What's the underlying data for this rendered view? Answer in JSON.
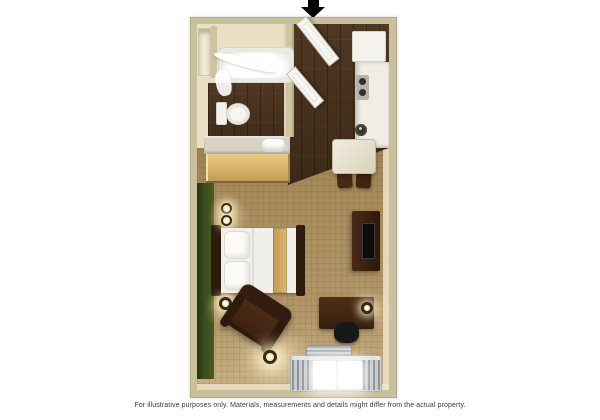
{
  "meta": {
    "kind": "3d-rendered studio suite floor plan",
    "width": 600,
    "height": 420,
    "background": "#ffffff"
  },
  "caption": "For illustrative purposes only.  Materials, measurements and details might differ from the actual property.",
  "entrance": {
    "icon": "down-arrow",
    "color": "#000000"
  },
  "palette": {
    "outer_wall": "#c9c09e",
    "interior_wall": "#e9dfc5",
    "dark_wood_floor": "#44301f",
    "carpet": "#aa8e5f",
    "accent_wall_green": "#3d4d1c",
    "furniture_wood": "#3a2010",
    "bedding_white": "#f1efe9",
    "bed_runner_gold": "#d3ab63",
    "counter_white": "#efede4",
    "vanity_wood": "#d6b267",
    "window_light": "#ffffff"
  },
  "rooms": [
    {
      "name": "bathroom",
      "features": [
        "bathtub",
        "shower-curtain",
        "toilet",
        "closet-nook"
      ]
    },
    {
      "name": "vanity-closet",
      "features": [
        "vanity-counter",
        "towel",
        "vanity-cabinet"
      ]
    },
    {
      "name": "entry-hall",
      "features": [
        "entry-door",
        "bathroom-door",
        "dark-wood-floor"
      ]
    },
    {
      "name": "kitchenette",
      "features": [
        "refrigerator",
        "counter",
        "cooktop",
        "sink"
      ]
    },
    {
      "name": "living-sleeping-area",
      "features": [
        "bed",
        "armchair",
        "desk",
        "tv-dresser",
        "dining-table",
        "window"
      ]
    }
  ],
  "furniture": [
    "bathtub",
    "toilet",
    "vanity-counter",
    "towel",
    "entry-door",
    "bathroom-door",
    "refrigerator",
    "cooktop",
    "kitchen-sink",
    "dining-table",
    "dining-chairs",
    "bed",
    "pillows",
    "wall-sconces",
    "bedside-lamp",
    "tv-dresser",
    "television",
    "desk",
    "desk-chair",
    "desk-lamp",
    "armchair",
    "floor-lamp",
    "ac-unit",
    "window-bench"
  ]
}
